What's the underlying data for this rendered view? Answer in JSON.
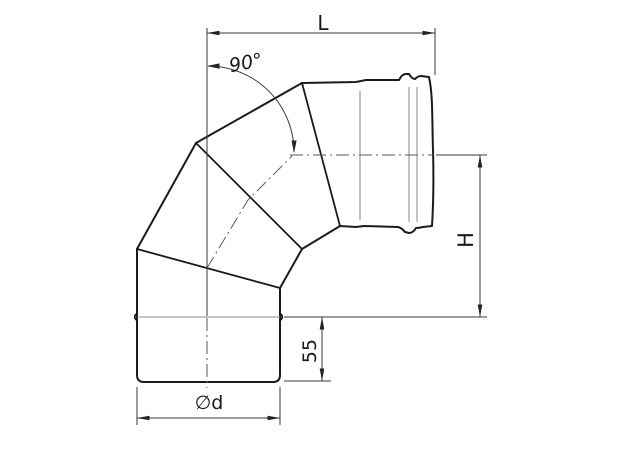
{
  "drawing": {
    "labels": {
      "length": "L",
      "angle": "90°",
      "height": "H",
      "stub_length": "55",
      "diameter": "∅d"
    }
  }
}
